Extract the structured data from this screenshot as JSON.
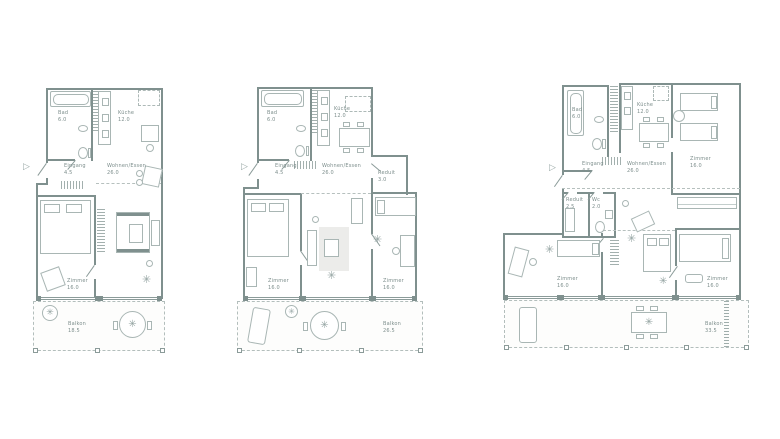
{
  "icons": {
    "plant": "✳",
    "entry_arrow": "▷"
  },
  "colors": {
    "wall": "#7f908e",
    "furniture_line": "#a9b6b4",
    "text": "#7d8e8c",
    "rug": "#ececea",
    "balcony_fill": "#fdfdfc",
    "background": "#ffffff"
  },
  "plans": [
    {
      "id": "apartment-left",
      "rooms": {
        "bad": {
          "label": "Bad",
          "area": "6.0"
        },
        "kueche": {
          "label": "Küche",
          "area": "12.0"
        },
        "eingang": {
          "label": "Eingang",
          "area": "4.5"
        },
        "wohnen_essen": {
          "label": "Wohnen/Essen",
          "area": "26.0"
        },
        "zimmer": {
          "label": "Zimmer",
          "area": "16.0"
        },
        "balkon": {
          "label": "Balkon",
          "area": "18.5"
        }
      }
    },
    {
      "id": "apartment-middle",
      "rooms": {
        "bad": {
          "label": "Bad",
          "area": "6.0"
        },
        "kueche": {
          "label": "Küche",
          "area": "12.0"
        },
        "eingang": {
          "label": "Eingang",
          "area": "4.5"
        },
        "wohnen_essen": {
          "label": "Wohnen/Essen",
          "area": "26.0"
        },
        "reduit": {
          "label": "Reduit",
          "area": "3.0"
        },
        "zimmer1": {
          "label": "Zimmer",
          "area": "16.0"
        },
        "zimmer2": {
          "label": "Zimmer",
          "area": "16.0"
        },
        "balkon": {
          "label": "Balkon",
          "area": "26.5"
        }
      }
    },
    {
      "id": "apartment-right",
      "rooms": {
        "bad": {
          "label": "Bad",
          "area": "6.0"
        },
        "kueche": {
          "label": "Küche",
          "area": "12.0"
        },
        "eingang": {
          "label": "Eingang",
          "area": "4.5"
        },
        "wohnen_essen": {
          "label": "Wohnen/Essen",
          "area": "26.0"
        },
        "zimmer1": {
          "label": "Zimmer",
          "area": "16.0"
        },
        "reduit": {
          "label": "Reduit",
          "area": "2.5"
        },
        "wc": {
          "label": "Wc",
          "area": "2.0"
        },
        "zimmer2": {
          "label": "Zimmer",
          "area": "16.0"
        },
        "zimmer3": {
          "label": "Zimmer",
          "area": "16.0"
        },
        "balkon": {
          "label": "Balkon",
          "area": "33.5"
        }
      }
    }
  ]
}
